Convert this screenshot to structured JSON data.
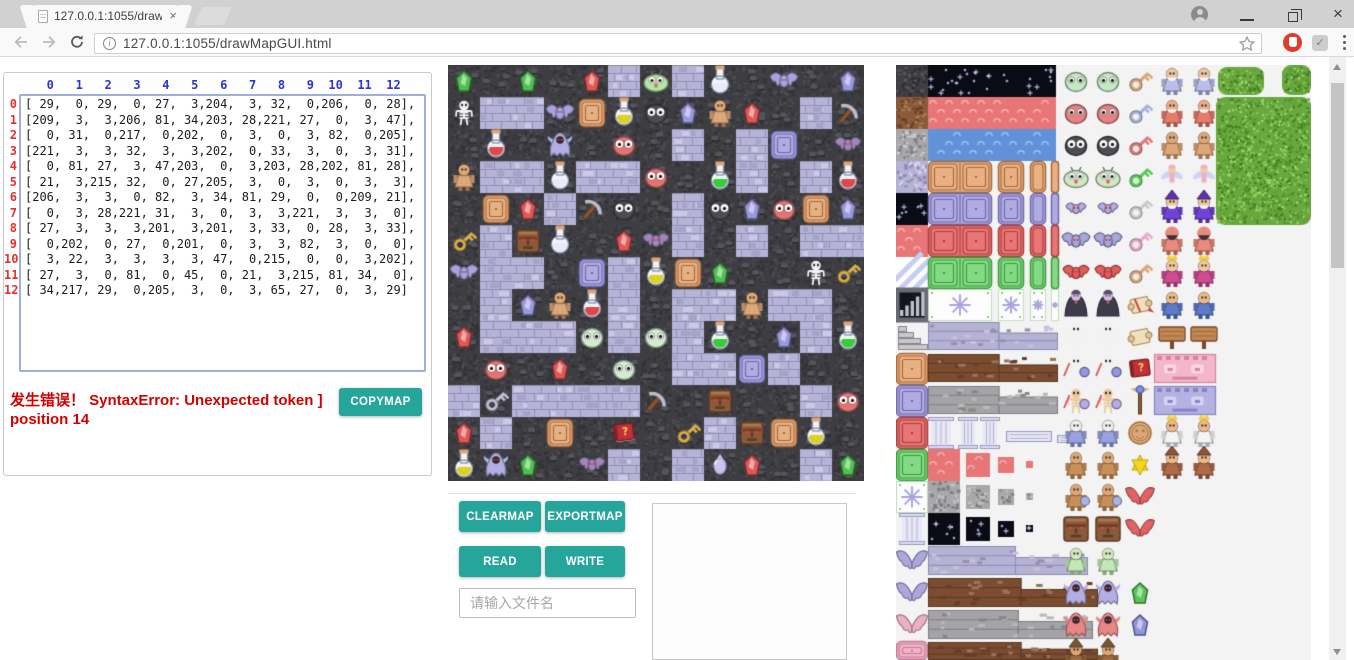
{
  "browser": {
    "tab_title": "127.0.0.1:1055/drawMa",
    "url": "127.0.0.1:1055/drawMapGUI.html",
    "icons": {
      "close": "×",
      "check": "✓",
      "minimize": "—"
    }
  },
  "matrix_panel": {
    "col_headers": [
      "0",
      "1",
      "2",
      "3",
      "4",
      "5",
      "6",
      "7",
      "8",
      "9",
      "10",
      "11",
      "12"
    ],
    "row_headers": [
      "0",
      "1",
      "2",
      "3",
      "4",
      "5",
      "6",
      "7",
      "8",
      "9",
      "10",
      "11",
      "12"
    ],
    "matrix": [
      [
        29,
        0,
        29,
        0,
        27,
        3,
        204,
        3,
        32,
        0,
        206,
        0,
        28
      ],
      [
        209,
        3,
        3,
        206,
        81,
        34,
        203,
        28,
        221,
        27,
        0,
        3,
        47
      ],
      [
        0,
        31,
        0,
        217,
        0,
        202,
        0,
        3,
        0,
        3,
        82,
        0,
        205
      ],
      [
        221,
        3,
        3,
        32,
        3,
        3,
        202,
        0,
        33,
        3,
        0,
        3,
        31
      ],
      [
        0,
        81,
        27,
        3,
        47,
        203,
        0,
        3,
        203,
        28,
        202,
        81,
        28
      ],
      [
        21,
        3,
        215,
        32,
        0,
        27,
        205,
        3,
        0,
        3,
        0,
        3,
        3
      ],
      [
        206,
        3,
        3,
        0,
        82,
        3,
        34,
        81,
        29,
        0,
        0,
        209,
        21
      ],
      [
        0,
        3,
        28,
        221,
        31,
        3,
        0,
        3,
        3,
        221,
        3,
        3,
        0
      ],
      [
        27,
        3,
        3,
        3,
        201,
        3,
        201,
        3,
        33,
        0,
        28,
        3,
        33
      ],
      [
        0,
        202,
        0,
        27,
        0,
        201,
        0,
        3,
        3,
        82,
        3,
        0,
        0
      ],
      [
        3,
        22,
        3,
        3,
        3,
        3,
        47,
        0,
        215,
        0,
        0,
        3,
        202
      ],
      [
        27,
        3,
        0,
        81,
        0,
        45,
        0,
        21,
        3,
        215,
        81,
        34,
        0
      ],
      [
        34,
        217,
        29,
        0,
        205,
        3,
        0,
        3,
        65,
        27,
        0,
        3,
        29
      ]
    ],
    "error_text": "发生错误！ SyntaxError: Unexpected token ] position 14",
    "copymap_label": "COPYMAP"
  },
  "controls": {
    "clearmap_label": "CLEARMAP",
    "exportmap_label": "EXPORTMAP",
    "read_label": "READ",
    "write_label": "WRITE",
    "filename_placeholder": "请输入文件名"
  },
  "colors": {
    "accent_teal": "#26a69a",
    "error_red": "#d40000",
    "header_blue": "#2a35d0",
    "row_red": "#e82f2f",
    "wall": "#3e3e42",
    "floor": "#b7b3d6"
  },
  "map": {
    "tile_size": 32,
    "cols": 13,
    "rows": 13,
    "tile_legend": {
      "0": {
        "k": "wall"
      },
      "3": {
        "k": "floor"
      },
      "21": {
        "k": "key",
        "c": "#d8b048"
      },
      "22": {
        "k": "key",
        "c": "#c0c0d8"
      },
      "27": {
        "k": "gem",
        "c": "#e05858"
      },
      "28": {
        "k": "gem",
        "c": "#9a96e0"
      },
      "29": {
        "k": "gem",
        "c": "#50c050"
      },
      "31": {
        "k": "flask",
        "c": "#e04848"
      },
      "32": {
        "k": "flask",
        "c": "#eaeaf8"
      },
      "33": {
        "k": "flask",
        "c": "#38cc38"
      },
      "34": {
        "k": "flask",
        "c": "#ddd020"
      },
      "45": {
        "k": "book",
        "c": "#c03038"
      },
      "47": {
        "k": "pickaxe"
      },
      "65": {
        "k": "charm"
      },
      "81": {
        "k": "door",
        "c": "tan"
      },
      "82": {
        "k": "door",
        "c": "purple"
      },
      "201": {
        "k": "blob",
        "c": "#d6ecd2"
      },
      "202": {
        "k": "blob",
        "c": "#e87272"
      },
      "203": {
        "k": "blob",
        "c": "#4c4c54"
      },
      "204": {
        "k": "slime",
        "c": "#b2e8a0"
      },
      "205": {
        "k": "bat",
        "c": "#9d88b8",
        "s": 26
      },
      "206": {
        "k": "bat",
        "c": "#a8a2e0",
        "s": 28
      },
      "209": {
        "k": "skeleton"
      },
      "215": {
        "k": "face",
        "s": 22
      },
      "217": {
        "k": "ghost",
        "c": "#b2aee4"
      },
      "221": {
        "k": "figure",
        "c": "#dca878",
        "s2": "#dca878"
      }
    }
  },
  "tileset": {
    "door_palettes": {
      "tan": [
        "#e8b184",
        "#a86838"
      ],
      "purple": [
        "#b0abe0",
        "#6f68b0"
      ],
      "red": [
        "#e87676",
        "#ac3c3c"
      ],
      "green": [
        "#84da84",
        "#3c9c3c"
      ],
      "pink": [
        "#f2b2c8",
        "#c47a96"
      ]
    },
    "sprites": [
      {
        "k": "tex",
        "x": 0,
        "y": 0,
        "w": 32,
        "h": 32,
        "c": "#3f3f42",
        "d": "#2f2f33",
        "l": "#55555b"
      },
      {
        "k": "tex",
        "x": 0,
        "y": 32,
        "w": 32,
        "h": 32,
        "c": "#8a5a3c",
        "d": "#6b4127",
        "l": "#a87b52"
      },
      {
        "k": "tex",
        "x": 0,
        "y": 64,
        "w": 32,
        "h": 32,
        "c": "#a8a8ab",
        "d": "#838387",
        "l": "#cacace"
      },
      {
        "k": "tex",
        "x": 0,
        "y": 96,
        "w": 32,
        "h": 32,
        "c": "#b6b2d4",
        "d": "#8f8bb5",
        "l": "#d7d4ec"
      },
      {
        "k": "starry",
        "x": 0,
        "y": 128,
        "w": 32,
        "h": 32
      },
      {
        "k": "band",
        "x": 0,
        "y": 160,
        "w": 32,
        "h": 32,
        "c": "#e87676",
        "l": "#f5b1b1"
      },
      {
        "k": "stripes",
        "x": 0,
        "y": 192,
        "w": 32,
        "h": 32
      },
      {
        "k": "bars",
        "x": 0,
        "y": 224
      },
      {
        "k": "stairs",
        "x": 0,
        "y": 256
      },
      {
        "k": "door",
        "x": 0,
        "y": 288,
        "w": 32,
        "h": 32,
        "c": "tan"
      },
      {
        "k": "door",
        "x": 0,
        "y": 320,
        "w": 32,
        "h": 32,
        "c": "purple"
      },
      {
        "k": "door",
        "x": 0,
        "y": 352,
        "w": 32,
        "h": 32,
        "c": "red"
      },
      {
        "k": "door",
        "x": 0,
        "y": 384,
        "w": 32,
        "h": 32,
        "c": "green"
      },
      {
        "k": "snow",
        "x": 0,
        "y": 416,
        "w": 32,
        "h": 32
      },
      {
        "k": "column",
        "x": 3,
        "y": 448,
        "w": 26,
        "h": 32
      },
      {
        "k": "wing",
        "x": 0,
        "y": 480,
        "s": 28,
        "c": "#aca8de"
      },
      {
        "k": "wing",
        "x": 0,
        "y": 512,
        "s": 28,
        "c": "#aca8de"
      },
      {
        "k": "wing",
        "x": 0,
        "y": 544,
        "s": 28,
        "c": "#edafc7"
      },
      {
        "k": "door",
        "x": 0,
        "y": 576,
        "w": 32,
        "h": 19,
        "c": "pink"
      },
      {
        "k": "starry",
        "x": 32,
        "y": 0,
        "w": 128,
        "h": 32
      },
      {
        "k": "band",
        "x": 32,
        "y": 32,
        "w": 128,
        "h": 32,
        "c": "#e87676",
        "l": "#f5b1b1"
      },
      {
        "k": "band",
        "x": 32,
        "y": 64,
        "w": 128,
        "h": 32,
        "c": "#6191d8",
        "l": "#9dc3ef"
      },
      {
        "k": "doorRow",
        "y": 96,
        "c": "tan"
      },
      {
        "k": "doorRow",
        "y": 128,
        "c": "purple"
      },
      {
        "k": "doorRow",
        "y": 160,
        "c": "red"
      },
      {
        "k": "doorRow",
        "y": 192,
        "c": "green"
      },
      {
        "k": "snowRow",
        "y": 224
      },
      {
        "k": "strip",
        "x": 32,
        "y": 257,
        "w": 130,
        "h": 28,
        "c": "#b6b2d4",
        "d": "#8f8bb5"
      },
      {
        "k": "strip",
        "x": 32,
        "y": 289,
        "w": 130,
        "h": 28,
        "c": "#7c4c30",
        "d": "#5a3820"
      },
      {
        "k": "strip",
        "x": 32,
        "y": 321,
        "w": 130,
        "h": 28,
        "c": "#a4a4a6",
        "d": "#7f7f83"
      },
      {
        "k": "column",
        "x": 32,
        "y": 352,
        "w": 26,
        "h": 32
      },
      {
        "k": "column",
        "x": 62,
        "y": 352,
        "w": 20,
        "h": 32
      },
      {
        "k": "column",
        "x": 84,
        "y": 352,
        "w": 20,
        "h": 32
      },
      {
        "k": "colrow",
        "x": 110,
        "y": 366,
        "w": 46,
        "h": 11
      },
      {
        "k": "colrow",
        "x": 161,
        "y": 370,
        "w": 27,
        "h": 8
      },
      {
        "k": "decRow",
        "y": 384,
        "t": "band",
        "c": "#e87676"
      },
      {
        "k": "decRow",
        "y": 416,
        "t": "tex",
        "c": "#a8a8ab"
      },
      {
        "k": "decRow",
        "y": 448,
        "t": "starry"
      },
      {
        "k": "strip",
        "x": 32,
        "y": 481,
        "w": 160,
        "h": 29,
        "c": "#b6b2d4",
        "d": "#8f8bb5"
      },
      {
        "k": "strip",
        "x": 32,
        "y": 513,
        "w": 170,
        "h": 29,
        "c": "#7c4c30",
        "d": "#5a3820"
      },
      {
        "k": "strip",
        "x": 32,
        "y": 545,
        "w": 165,
        "h": 29,
        "c": "#a4a4a6",
        "d": "#7f7f83"
      },
      {
        "k": "strip",
        "x": 32,
        "y": 577,
        "w": 170,
        "h": 18,
        "c": "#7c4c30",
        "d": "#5a3820"
      },
      {
        "k": "blob",
        "p": 2,
        "x": 164,
        "y": 0,
        "c": "#c4eac4"
      },
      {
        "k": "blob",
        "p": 2,
        "x": 164,
        "y": 32,
        "c": "#ea8282"
      },
      {
        "k": "blob",
        "p": 2,
        "x": 164,
        "y": 64,
        "c": "#4c4c54"
      },
      {
        "k": "slime",
        "p": 2,
        "x": 164,
        "y": 96,
        "c": "#cfe9c4"
      },
      {
        "k": "bat",
        "p": 2,
        "x": 164,
        "y": 128,
        "s": 20,
        "c": "#b3afe3"
      },
      {
        "k": "bat",
        "p": 2,
        "x": 164,
        "y": 160,
        "s": 28,
        "c": "#a9a5dd"
      },
      {
        "k": "bat",
        "p": 2,
        "x": 164,
        "y": 192,
        "s": 26,
        "c": "#e25c5c"
      },
      {
        "k": "vampire",
        "p": 2,
        "x": 164,
        "y": 224
      },
      {
        "k": "skeleton",
        "p": 2,
        "x": 164,
        "y": 256
      },
      {
        "k": "skeleton",
        "p": 2,
        "x": 164,
        "y": 288,
        "c": "#8f97e0"
      },
      {
        "k": "skeleton",
        "p": 2,
        "x": 164,
        "y": 320,
        "c": "#b5abe6",
        "t": "#eccaa4"
      },
      {
        "k": "figure",
        "p": 2,
        "x": 164,
        "y": 352,
        "c": "#98a2e2",
        "s2": "#f2f2f2"
      },
      {
        "k": "figure",
        "p": 2,
        "x": 164,
        "y": 384,
        "c": "#c89058",
        "s2": "#dca878"
      },
      {
        "k": "figure",
        "p": 2,
        "x": 164,
        "y": 416,
        "c": "#c89058",
        "s2": "#dca878",
        "sh": "#aab2e8"
      },
      {
        "k": "face",
        "p": 2,
        "x": 164,
        "y": 448,
        "s": 24
      },
      {
        "k": "figure",
        "p": 2,
        "x": 164,
        "y": 480,
        "c": "#c3e7b7",
        "s2": "#cfecc4"
      },
      {
        "k": "ghost",
        "p": 2,
        "x": 164,
        "y": 512,
        "c": "#b3afe5"
      },
      {
        "k": "ghost",
        "p": 2,
        "x": 164,
        "y": 544,
        "c": "#e98686"
      },
      {
        "k": "figure",
        "p": 2,
        "x": 164,
        "y": 576,
        "c": "#9a6a42",
        "s2": "#dca878",
        "h": 1
      },
      {
        "k": "key",
        "x": 228,
        "y": 0,
        "c": "#d8a878"
      },
      {
        "k": "key",
        "x": 228,
        "y": 32,
        "c": "#a9b1e1"
      },
      {
        "k": "key",
        "x": 228,
        "y": 64,
        "c": "#e07a7a"
      },
      {
        "k": "key",
        "x": 228,
        "y": 96,
        "c": "#58cc58"
      },
      {
        "k": "key",
        "x": 228,
        "y": 128,
        "c": "#c7cdc7"
      },
      {
        "k": "key",
        "x": 228,
        "y": 160,
        "c": "#e9aac9"
      },
      {
        "k": "key",
        "x": 228,
        "y": 192,
        "c": "#d8a878"
      },
      {
        "k": "scroll",
        "x": 228,
        "y": 224,
        "c": "#d84040"
      },
      {
        "k": "scroll",
        "x": 228,
        "y": 256
      },
      {
        "k": "book",
        "x": 228,
        "y": 288,
        "c": "#c23038"
      },
      {
        "k": "staff",
        "x": 228,
        "y": 320
      },
      {
        "k": "coin",
        "x": 228,
        "y": 352
      },
      {
        "k": "star",
        "x": 228,
        "y": 384,
        "c": "#f2d820"
      },
      {
        "k": "wing",
        "x": 228,
        "y": 416,
        "s": 26,
        "c": "#e06464"
      },
      {
        "k": "wing",
        "x": 228,
        "y": 448,
        "s": 26,
        "c": "#e06464"
      },
      {
        "k": "gem",
        "x": 228,
        "y": 512,
        "c": "#58c858"
      },
      {
        "k": "gem",
        "x": 228,
        "y": 544,
        "c": "#8f97e0"
      },
      {
        "k": "figure",
        "p": 2,
        "x": 260,
        "y": 0,
        "c": "#b9bde9",
        "s2": "#f0c8a0",
        "b": 1
      },
      {
        "k": "figure",
        "p": 2,
        "x": 260,
        "y": 32,
        "c": "#e87a6a",
        "s2": "#eab088",
        "b": 1
      },
      {
        "k": "figure",
        "p": 2,
        "x": 260,
        "y": 64,
        "c": "#dca878",
        "s2": "#dca878"
      },
      {
        "k": "fairy",
        "p": 2,
        "x": 260,
        "y": 96,
        "c": "#eab0c4"
      },
      {
        "k": "figure",
        "p": 2,
        "x": 260,
        "y": 128,
        "c": "#7142d8",
        "s2": "#f0c8a0",
        "b": 1,
        "h": 1
      },
      {
        "k": "figure",
        "p": 2,
        "x": 260,
        "y": 160,
        "c": "#ea8a7a",
        "s2": "#3a3038",
        "h": 2
      },
      {
        "k": "figure",
        "p": 2,
        "x": 260,
        "y": 192,
        "c": "#d14a92",
        "s2": "#f0c8a0",
        "cr": 1
      },
      {
        "k": "figure",
        "p": 2,
        "x": 260,
        "y": 224,
        "c": "#5a7aca",
        "s2": "#ecba8a"
      },
      {
        "k": "sign",
        "p": 2,
        "x": 260,
        "y": 256
      },
      {
        "k": "wallface",
        "x": 258,
        "y": 289,
        "w": 62,
        "h": 29,
        "c": "#f3b7cb",
        "d": "#d784a0"
      },
      {
        "k": "wallface",
        "x": 258,
        "y": 321,
        "w": 62,
        "h": 29,
        "c": "#b5b1e3",
        "d": "#8983c5"
      },
      {
        "k": "figure",
        "p": 2,
        "x": 260,
        "y": 352,
        "c": "#f4f4f4",
        "s2": "#ecba8a",
        "cr": 1
      },
      {
        "k": "figure",
        "p": 2,
        "x": 260,
        "y": 384,
        "c": "#b06a48",
        "s2": "#ecba8a",
        "h": 1
      },
      {
        "k": "tree",
        "x": 322,
        "y": 2,
        "w": 46,
        "h": 28
      },
      {
        "k": "tree",
        "x": 386,
        "y": 0,
        "w": 29,
        "h": 30
      },
      {
        "k": "tree",
        "x": 320,
        "y": 32,
        "w": 95,
        "h": 128
      }
    ]
  }
}
